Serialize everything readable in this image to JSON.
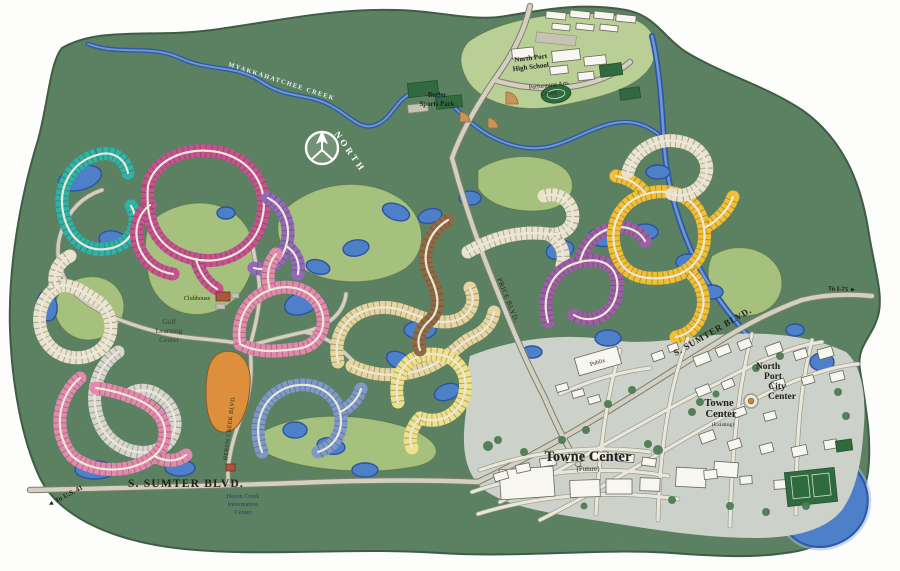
{
  "map": {
    "labels": {
      "compass": "NORTH",
      "creek": "MYAKKAHATCHEE CREEK",
      "sumter_south": "S. SUMTER BLVD.",
      "sumter_east": "S. SUMTER BLVD.",
      "price": "PRICE BLVD.",
      "heron_creek_blvd": "HERON CREEK BLVD.",
      "to_us41": "◄ To U.S. 41",
      "to_i75": "To I-75 ►",
      "high_school_l1": "North Port",
      "high_school_l2": "High School",
      "pac_l1": "Performing Arts",
      "pac_l2": "Center",
      "butler_l1": "Butler",
      "butler_l2": "Sports Park",
      "glc_l1": "Golf",
      "glc_l2": "Learning",
      "glc_l3": "Center",
      "clubhouse": "Clubhouse",
      "publix": "Publix",
      "towne_future_l1": "Towne Center",
      "towne_future_l2": "(Future)",
      "towne_exist_l1": "Towne",
      "towne_exist_l2": "Center",
      "towne_exist_l3": "(Existing)",
      "city_center_l1": "North",
      "city_center_l2": "Port",
      "city_center_l3": "City",
      "city_center_l4": "Center",
      "info_l1": "Heron Creek",
      "info_l2": "Information",
      "info_l3": "Center"
    },
    "colors": {
      "forest": "#5d8160",
      "fairway": "#a6c07e",
      "water": "#4d80c8",
      "teal": "#2eb3a6",
      "magenta": "#c4538f",
      "violet": "#9268b8",
      "pink": "#e289ad",
      "cream": "#e9e3cd",
      "gray": "#d7d7cf",
      "slate": "#7d99c9",
      "tan": "#e7d5a0",
      "light_yellow": "#efe08a",
      "gold": "#f0bf35",
      "brown": "#8f6b45",
      "plum": "#9c5fa5",
      "orange": "#dd8f3c"
    }
  }
}
